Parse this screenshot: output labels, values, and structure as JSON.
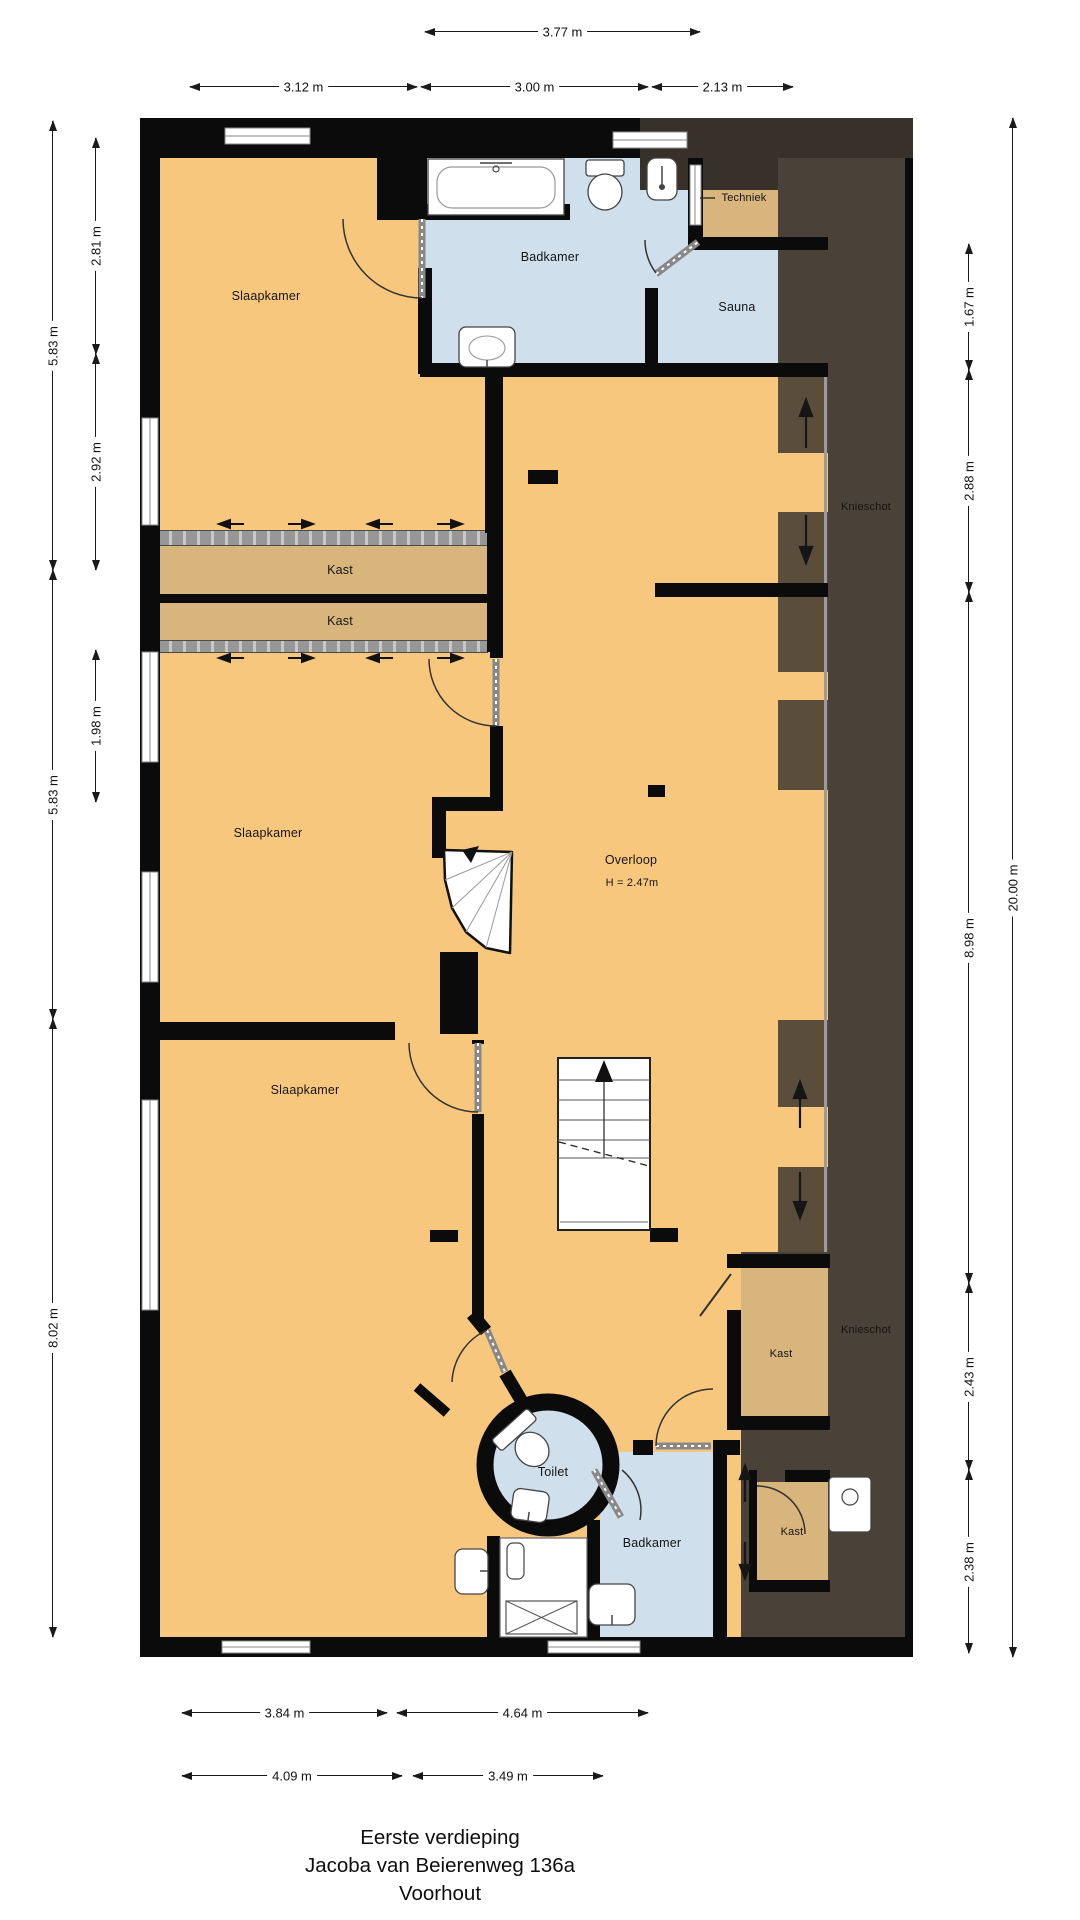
{
  "title": {
    "line1": "Eerste verdieping",
    "line2": "Jacoba van Beierenweg 136a",
    "line3": "Voorhout"
  },
  "rooms": {
    "slaapkamer_top": "Slaapkamer",
    "badkamer_top": "Badkamer",
    "techniek": "Techniek",
    "sauna": "Sauna",
    "kast_a": "Kast",
    "kast_b": "Kast",
    "slaapkamer_mid": "Slaapkamer",
    "overloop": "Overloop",
    "overloop_height": "H = 2.47m",
    "knieschot_top": "Knieschot",
    "slaapkamer_bottom": "Slaapkamer",
    "kast_c": "Kast",
    "knieschot_bottom": "Knieschot",
    "toilet": "Toilet",
    "badkamer_bottom": "Badkamer",
    "kast_d": "Kast"
  },
  "dimensions": {
    "top": [
      "3.77 m",
      "3.12 m",
      "3.00 m",
      "2.13 m"
    ],
    "left": [
      "5.83 m",
      "5.83 m",
      "8.02 m",
      "2.81 m",
      "2.92 m",
      "1.98 m"
    ],
    "right": [
      "1.67 m",
      "2.88 m",
      "8.98 m",
      "2.43 m",
      "2.38 m",
      "20.00 m"
    ],
    "bottom": [
      "3.84 m",
      "4.64 m",
      "4.09 m",
      "3.49 m"
    ]
  },
  "colors": {
    "floor": "#f8c77e",
    "closet": "#d9b57e",
    "wet_room": "#cfdfeb",
    "knieschot_dark": "#4a4138",
    "knieschot_light": "#5b4d3b",
    "wall": "#0b0b0b"
  }
}
